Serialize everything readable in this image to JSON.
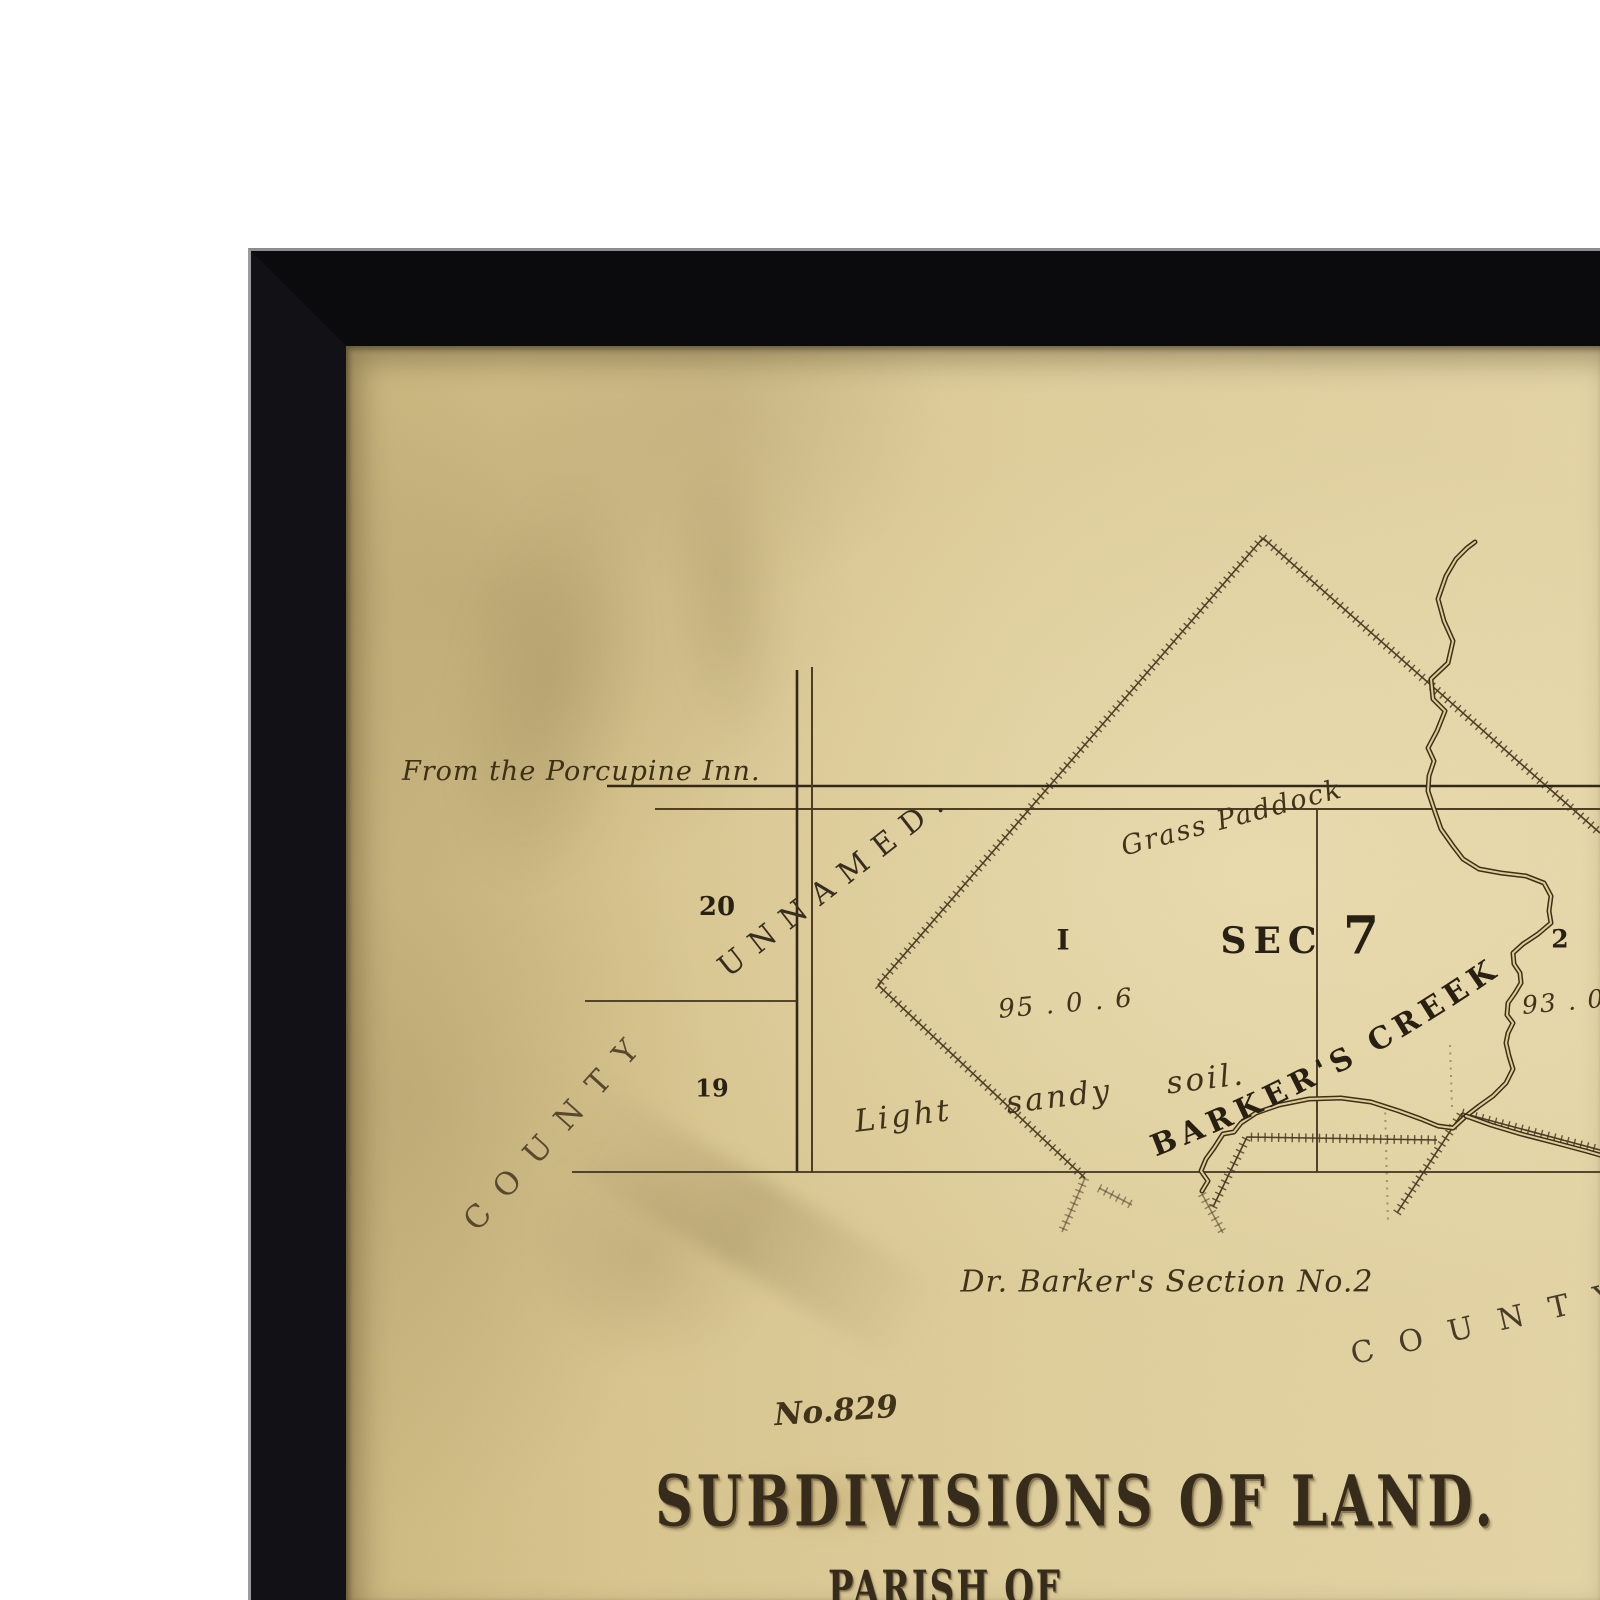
{
  "artwork": {
    "frame_color": "#0b0b0e",
    "paper_color": "#d9c68f",
    "ink_color": "#2f2517"
  },
  "map": {
    "plan_number": "No.829",
    "title": "SUBDIVISIONS OF LAND.",
    "subtitle": "PARISH OF",
    "labels": {
      "from_inn": "From the Porcupine Inn.",
      "unnamed_road": "UNNAMED.",
      "county_left": "COUNTY",
      "county_right": "COUNTY",
      "grass_paddock": "Grass Paddock",
      "sec": "SEC",
      "sec_number": "7",
      "lot20": "20",
      "lot19": "19",
      "lot1": "I",
      "lot1_area": "95 . 0 . 6",
      "lot2": "2",
      "lot2_area": "93 . 0 . 5",
      "soil_note": "Light sandy soil.",
      "creek_name": "BARKER'S CREEK",
      "section_note": "Dr. Barker's Section No.2"
    }
  }
}
